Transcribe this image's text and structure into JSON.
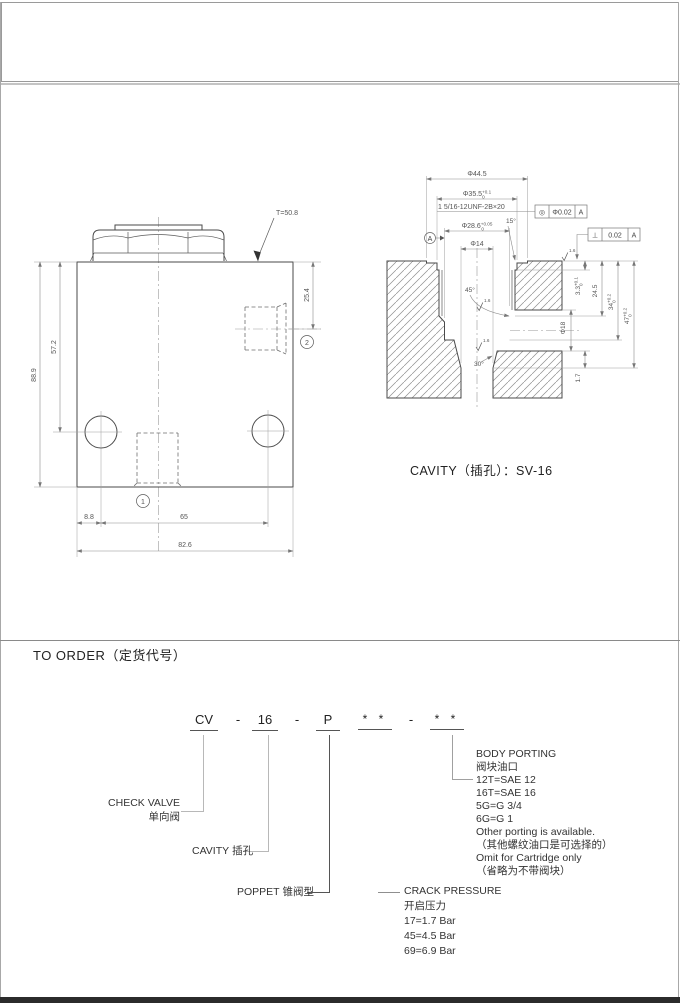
{
  "valve_view": {
    "t_label": "T=50.8",
    "port1": "1",
    "port2": "2",
    "dims": {
      "d88_9": "88.9",
      "d57_2": "57.2",
      "d25_4": "25.4",
      "d8_8": "8.8",
      "d65": "65",
      "d82_6": "82.6"
    }
  },
  "cavity_view": {
    "caption": "CAVITY（插孔）：SV-16",
    "thread": "1 5/16-12UNF-2B×20",
    "d44_5": "Φ44.5",
    "d35_5": {
      "value": "Φ35.5",
      "up": "+0.1",
      "dn": "0"
    },
    "d28_6": {
      "value": "Φ28.6",
      "up": "+0.05",
      "dn": "0"
    },
    "d14": "Φ14",
    "d18": "Φ18",
    "depth3_3": {
      "value": "3.3",
      "up": "+0.1",
      "dn": "0"
    },
    "depth24_5": "24.5",
    "depth34": {
      "value": "34",
      "up": "+0.2",
      "dn": "0"
    },
    "depth47": {
      "value": "47",
      "up": "+0.2",
      "dn": "0"
    },
    "depth1_7": "1.7",
    "angle15": "15°",
    "angle45": "45°",
    "angle30": "30°",
    "finish": "1.6",
    "gdt_concentricity": {
      "symbol": "◎",
      "value": "Φ0.02",
      "datum": "A"
    },
    "gdt_perpendicularity": {
      "symbol": "⊥",
      "value": "0.02",
      "datum": "A"
    },
    "datum": "A"
  },
  "order": {
    "title": "TO ORDER（定货代号）",
    "code": {
      "model": "CV",
      "sep1": "-",
      "size": "16",
      "sep2": "-",
      "type": "P",
      "stars1": "* *",
      "sep3": "-",
      "stars2": "* *"
    },
    "check_valve": {
      "en": "CHECK VALVE",
      "zh": "单向阀"
    },
    "cavity": {
      "en": "CAVITY",
      "zh": "插孔"
    },
    "poppet": {
      "en": "POPPET",
      "zh": "锥阀型"
    },
    "crack_pressure": {
      "en": "CRACK PRESSURE",
      "zh": "开启压力",
      "options": [
        "17=1.7 Bar",
        "45=4.5 Bar",
        "69=6.9 Bar"
      ]
    },
    "body_porting": {
      "en": "BODY PORTING",
      "zh": "阀块油口",
      "options": [
        "12T=SAE 12",
        "16T=SAE 16",
        "5G=G 3/4",
        "6G=G 1"
      ],
      "notes": [
        "Other porting is available.",
        "（其他螺纹油口是可选择的）",
        "Omit for Cartridge only",
        "（省略为不带阀块）"
      ]
    }
  }
}
